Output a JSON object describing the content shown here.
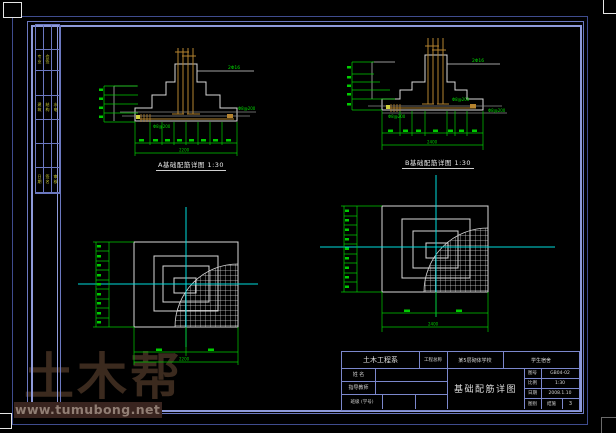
{
  "watermark": {
    "brand": "土木帮",
    "url": "www.tumubong.net"
  },
  "sign_table": {
    "rows": [
      [
        "",
        "",
        ""
      ],
      [
        "专业",
        "会签",
        ""
      ],
      [
        "",
        "",
        ""
      ],
      [
        "建筑",
        "结构",
        "水电"
      ],
      [
        "",
        "",
        ""
      ],
      [
        "",
        "",
        ""
      ],
      [
        "日期",
        "签名",
        "审核"
      ]
    ]
  },
  "captions": {
    "section_a": "A基础配筋详图 1:30",
    "section_b": "B基础配筋详图 1:30"
  },
  "labels": {
    "col_rebar": "2Φ16",
    "mesh": "Φ8@200"
  },
  "dims": {
    "section_a_overall": "2200",
    "section_b_overall": "2400",
    "plan_a_overall": "2200",
    "plan_b_overall": "2400"
  },
  "title_block": {
    "department": "土木工程系",
    "project_label": "工程总称",
    "project_name": "某5层砌体学校",
    "subproject": "学生宿舍",
    "name_label": "姓 名",
    "advisor_label": "指导教师",
    "class_label": "班级 (学号)",
    "drawing_title": "基础配筋详图",
    "info_rows": [
      {
        "label": "图号",
        "value": "GB04-02",
        "extra": ""
      },
      {
        "label": "比例",
        "value": "1:30",
        "extra": ""
      },
      {
        "label": "日期",
        "value": "2008.1.10",
        "extra": ""
      },
      {
        "label": "图别",
        "value": "结施",
        "extra": "3"
      }
    ]
  }
}
